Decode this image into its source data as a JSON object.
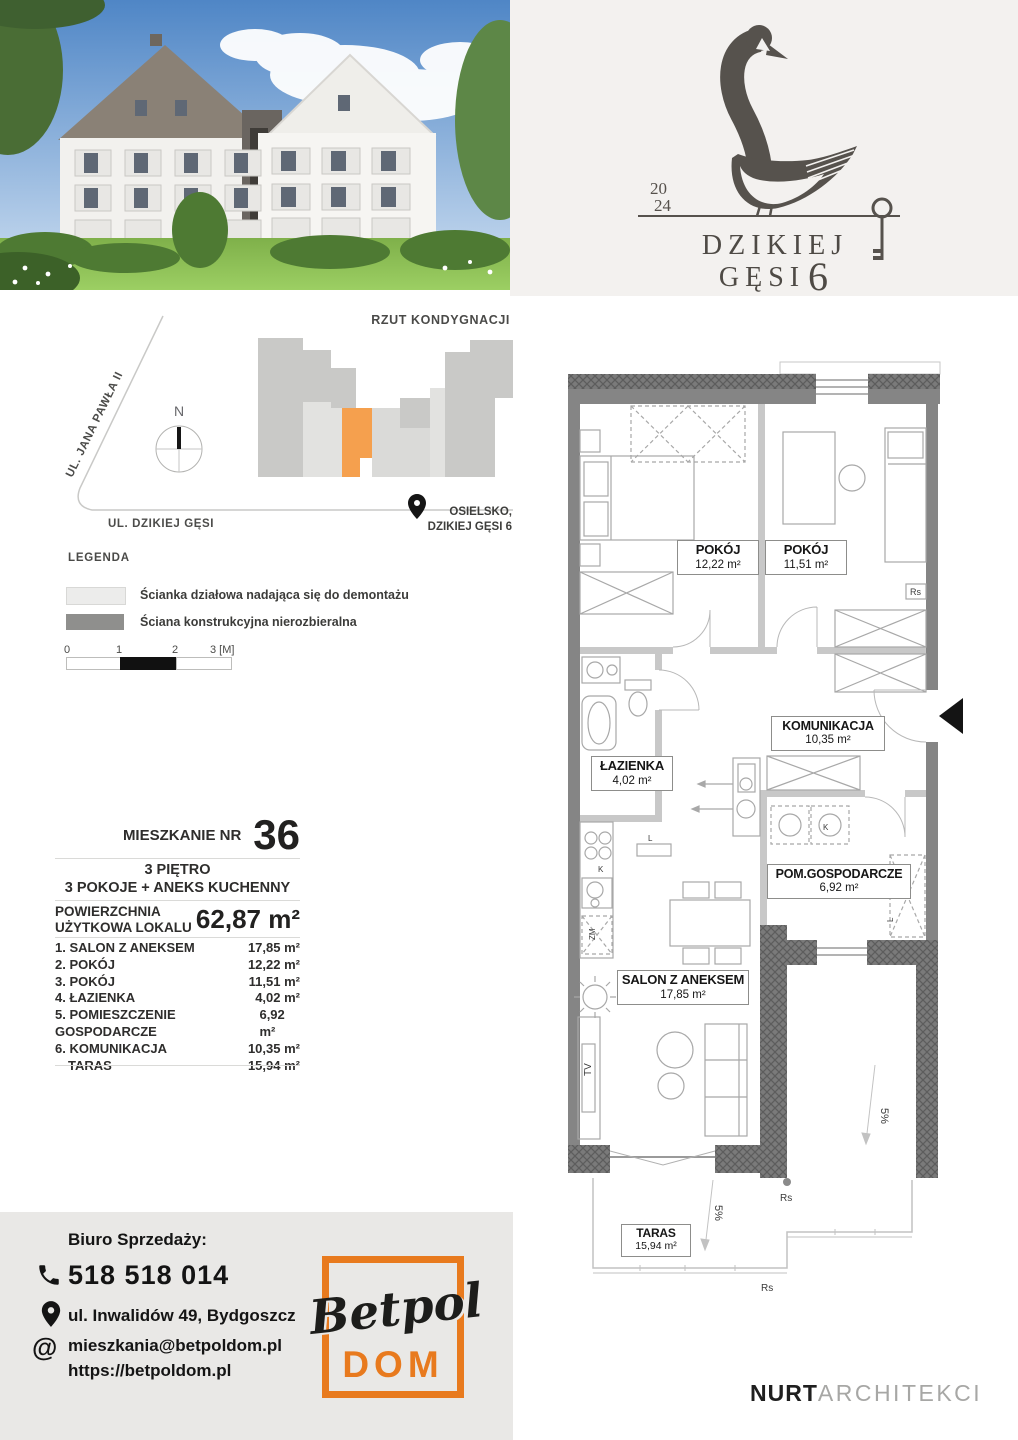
{
  "logo": {
    "year_line1": "20",
    "year_line2": "24",
    "name_line1": "DZIKIEJ",
    "name_line2": "GĘSI",
    "number": "6"
  },
  "site_plan": {
    "title": "RZUT KONDYGNACJI",
    "street_diagonal": "UL. JANA PAWŁA II",
    "street_bottom": "UL. DZIKIEJ GĘSI",
    "location_line1": "OSIELSKO,",
    "location_line2": "DZIKIEJ GĘSI 6",
    "unit_color": "#f5a04e"
  },
  "legend": {
    "title": "LEGENDA",
    "items": [
      {
        "label": "Ścianka działowa nadająca się do demontażu"
      },
      {
        "label": "Ściana konstrukcyjna nierozbieralna"
      }
    ],
    "scale_ticks": [
      "0",
      "1",
      "2",
      "3 [M]"
    ]
  },
  "apartment": {
    "label": "MIESZKANIE NR",
    "number": "36",
    "floor": "3 PIĘTRO",
    "layout": "3 POKOJE + ANEKS KUCHENNY",
    "area_label_line1": "POWIERZCHNIA",
    "area_label_line2": "UŻYTKOWA LOKALU",
    "area_value": "62,87 m²"
  },
  "room_list": [
    {
      "label": "1. SALON Z ANEKSEM",
      "area": "17,85 m²"
    },
    {
      "label": "2. POKÓJ",
      "area": "12,22 m²"
    },
    {
      "label": "3. POKÓJ",
      "area": "11,51 m²"
    },
    {
      "label": "4. ŁAZIENKA",
      "area": "4,02 m²"
    },
    {
      "label": "5. POMIESZCZENIE GOSPODARCZE",
      "area": "6,92 m²"
    },
    {
      "label": "6. KOMUNIKACJA",
      "area": "10,35 m²"
    },
    {
      "label": "TARAS",
      "area": "15,94 m²"
    }
  ],
  "floor_plan": {
    "rooms": [
      {
        "name": "POKÓJ",
        "area": "12,22 m²"
      },
      {
        "name": "POKÓJ",
        "area": "11,51 m²"
      },
      {
        "name": "KOMUNIKACJA",
        "area": "10,35 m²"
      },
      {
        "name": "ŁAZIENKA",
        "area": "4,02 m²"
      },
      {
        "name": "POM.GOSPODARCZE",
        "area": "6,92 m²"
      },
      {
        "name": "SALON Z ANEKSEM",
        "area": "17,85 m²"
      },
      {
        "name": "TARAS",
        "area": "15,94 m²"
      }
    ],
    "annotations": {
      "rs": "Rs",
      "slope": "5%",
      "tv": "TV",
      "k": "K",
      "zm": "ZM",
      "l": "L",
      "north": "N"
    }
  },
  "footer": {
    "office": "Biuro Sprzedaży:",
    "phone": "518 518 014",
    "address": "ul. Inwalidów 49, Bydgoszcz",
    "at_sign": "@",
    "email": "mieszkania@betpoldom.pl",
    "website": "https://betpoldom.pl",
    "brand": {
      "script": "Betpol",
      "caps": "DOM",
      "accent": "#e87a1e"
    }
  },
  "architect": {
    "name_bold": "NURT",
    "name_light": "ARCHITEKCI"
  }
}
